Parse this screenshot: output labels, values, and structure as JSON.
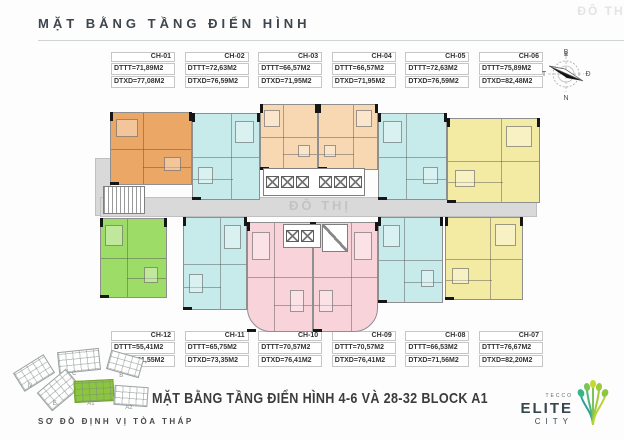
{
  "header": {
    "title": "MẶT BẰNG TẦNG ĐIỂN HÌNH",
    "watermark": "ĐÔ THỊ"
  },
  "footer": {
    "plan_title": "MẶT BẰNG TẦNG ĐIỂN HÌNH 4-6 VÀ 28-32 BLOCK A1",
    "site_map_caption": "SƠ ĐỒ ĐỊNH VỊ TÒA THÁP"
  },
  "compass": {
    "north": "B",
    "east": "Đ",
    "south": "N",
    "west": "T"
  },
  "logo": {
    "brand": "TECCO",
    "name_line1": "ELITE",
    "name_line2": "CITY"
  },
  "unit_labels": {
    "top": [
      {
        "id": "CH-01",
        "dttt": "DTTT=71,89M2",
        "dtxd": "DTXD=77,08M2"
      },
      {
        "id": "CH-02",
        "dttt": "DTTT=72,63M2",
        "dtxd": "DTXD=76,59M2"
      },
      {
        "id": "CH-03",
        "dttt": "DTTT=66,57M2",
        "dtxd": "DTXD=71,95M2"
      },
      {
        "id": "CH-04",
        "dttt": "DTTT=66,57M2",
        "dtxd": "DTXD=71,95M2"
      },
      {
        "id": "CH-05",
        "dttt": "DTTT=72,63M2",
        "dtxd": "DTXD=76,59M2"
      },
      {
        "id": "CH-06",
        "dttt": "DTTT=75,89M2",
        "dtxd": "DTXD=82,48M2"
      }
    ],
    "bottom": [
      {
        "id": "CH-12",
        "dttt": "DTTT=55,41M2",
        "dtxd": "DTXD=61,55M2"
      },
      {
        "id": "CH-11",
        "dttt": "DTTT=65,75M2",
        "dtxd": "DTXD=73,35M2"
      },
      {
        "id": "CH-10",
        "dttt": "DTTT=70,57M2",
        "dtxd": "DTXD=76,41M2"
      },
      {
        "id": "CH-09",
        "dttt": "DTTT=70,57M2",
        "dtxd": "DTXD=76,41M2"
      },
      {
        "id": "CH-08",
        "dttt": "DTTT=66,53M2",
        "dtxd": "DTXD=71,56M2"
      },
      {
        "id": "CH-07",
        "dttt": "DTTT=76,67M2",
        "dtxd": "DTXD=82,20M2"
      }
    ]
  },
  "plan": {
    "watermark": "ĐÔ THỊ",
    "colors": {
      "orange": "#eba766",
      "peach": "#f8d8b2",
      "cyan": "#c7eaea",
      "yellow": "#f3eaa4",
      "pink": "#f8d3da",
      "green": "#9edc68",
      "corridor": "#d9d9d9",
      "wall": "#161616"
    },
    "units": [
      {
        "id": "CH-01",
        "color": "orange",
        "x": 15,
        "y": 14,
        "w": 82,
        "h": 73
      },
      {
        "id": "CH-02",
        "color": "cyan",
        "x": 97,
        "y": 15,
        "w": 68,
        "h": 87
      },
      {
        "id": "CH-03",
        "color": "peach",
        "x": 165,
        "y": 6,
        "w": 58,
        "h": 66
      },
      {
        "id": "CH-04",
        "color": "peach",
        "x": 223,
        "y": 6,
        "w": 60,
        "h": 66
      },
      {
        "id": "CH-05",
        "color": "cyan",
        "x": 283,
        "y": 15,
        "w": 69,
        "h": 87
      },
      {
        "id": "CH-06",
        "color": "yellow",
        "x": 352,
        "y": 20,
        "w": 93,
        "h": 85
      },
      {
        "id": "CH-12",
        "color": "green",
        "x": 5,
        "y": 120,
        "w": 67,
        "h": 80
      },
      {
        "id": "CH-11",
        "color": "cyan",
        "x": 88,
        "y": 119,
        "w": 64,
        "h": 93
      },
      {
        "id": "CH-10",
        "color": "pink",
        "x": 152,
        "y": 124,
        "w": 66,
        "h": 110,
        "round": "bl"
      },
      {
        "id": "CH-09",
        "color": "pink",
        "x": 218,
        "y": 124,
        "w": 65,
        "h": 110,
        "round": "br"
      },
      {
        "id": "CH-08",
        "color": "cyan",
        "x": 283,
        "y": 119,
        "w": 65,
        "h": 86
      },
      {
        "id": "CH-07",
        "color": "yellow",
        "x": 350,
        "y": 119,
        "w": 78,
        "h": 83
      }
    ]
  },
  "site_map": {
    "buildings": [
      {
        "label": "D",
        "x": 2,
        "y": 14,
        "w": 34,
        "h": 20,
        "r": -32,
        "highlight": false
      },
      {
        "label": "C",
        "x": 44,
        "y": 2,
        "w": 40,
        "h": 20,
        "r": -6,
        "highlight": false
      },
      {
        "label": "B",
        "x": 94,
        "y": 6,
        "w": 32,
        "h": 18,
        "r": 16,
        "highlight": false
      },
      {
        "label": "E",
        "x": 26,
        "y": 30,
        "w": 36,
        "h": 22,
        "r": -40,
        "highlight": false
      },
      {
        "label": "A1",
        "x": 60,
        "y": 32,
        "w": 38,
        "h": 20,
        "r": -3,
        "highlight": true
      },
      {
        "label": "A2",
        "x": 100,
        "y": 38,
        "w": 32,
        "h": 18,
        "r": 4,
        "highlight": false
      }
    ]
  }
}
